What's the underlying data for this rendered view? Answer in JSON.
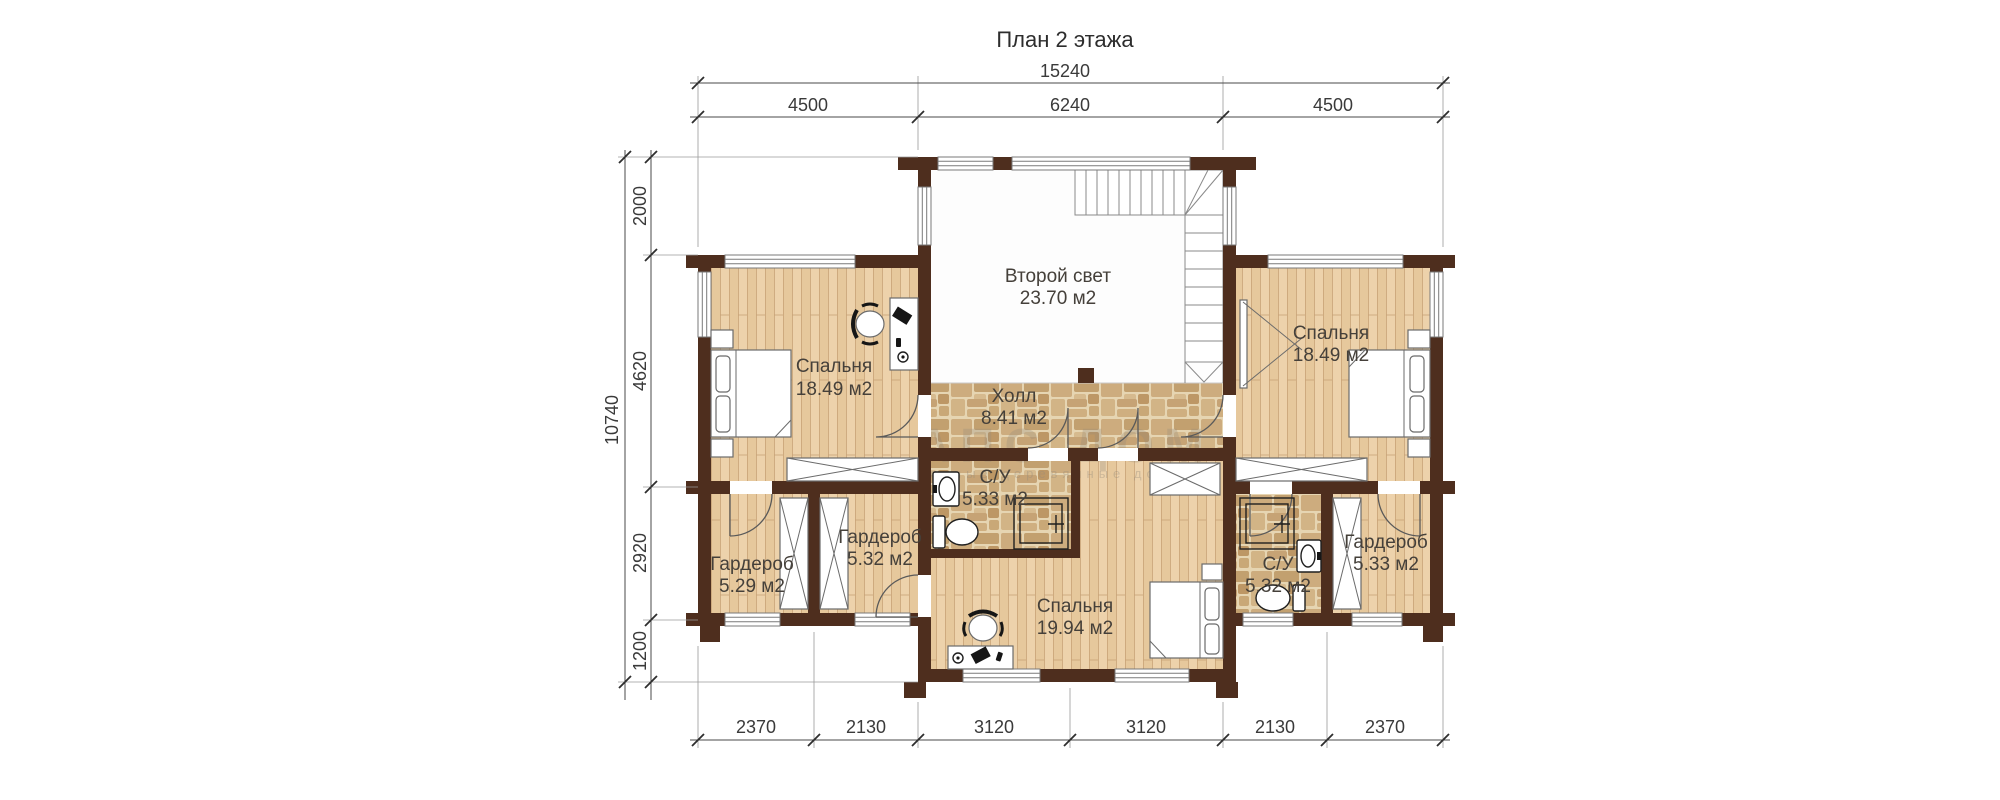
{
  "title": "План 2 этажа",
  "watermark": {
    "main": "АПС ДОМ",
    "sub": "основательные деревянные дома"
  },
  "dimensions": {
    "top_total": "15240",
    "top_segments": [
      "4500",
      "6240",
      "4500"
    ],
    "left_total": "10740",
    "left_segments": [
      "2000",
      "4620",
      "2920",
      "1200"
    ],
    "bottom_segments": [
      "2370",
      "2130",
      "3120",
      "3120",
      "2130",
      "2370"
    ]
  },
  "rooms": [
    {
      "name": "Спальня",
      "area": "18.49 м2"
    },
    {
      "name": "Второй свет",
      "area": "23.70 м2"
    },
    {
      "name": "Холл",
      "area": "8.41 м2"
    },
    {
      "name": "С/У",
      "area": "5.33 м2"
    },
    {
      "name": "Гардероб",
      "area": "5.32 м2"
    },
    {
      "name": "Гардероб",
      "area": "5.29 м2"
    },
    {
      "name": "Спальня",
      "area": "19.94 м2"
    },
    {
      "name": "С/У",
      "area": "5.32 м2"
    },
    {
      "name": "Гардероб",
      "area": "5.33 м2"
    },
    {
      "name": "Спальня",
      "area": "18.49 м2"
    }
  ],
  "colors": {
    "wall": "#4E2E1E",
    "wood_floor": "#EACDA4",
    "stone_floor": "#D9C096",
    "open_space": "#FFFFFF",
    "dimension_text": "#3A3A3A"
  }
}
